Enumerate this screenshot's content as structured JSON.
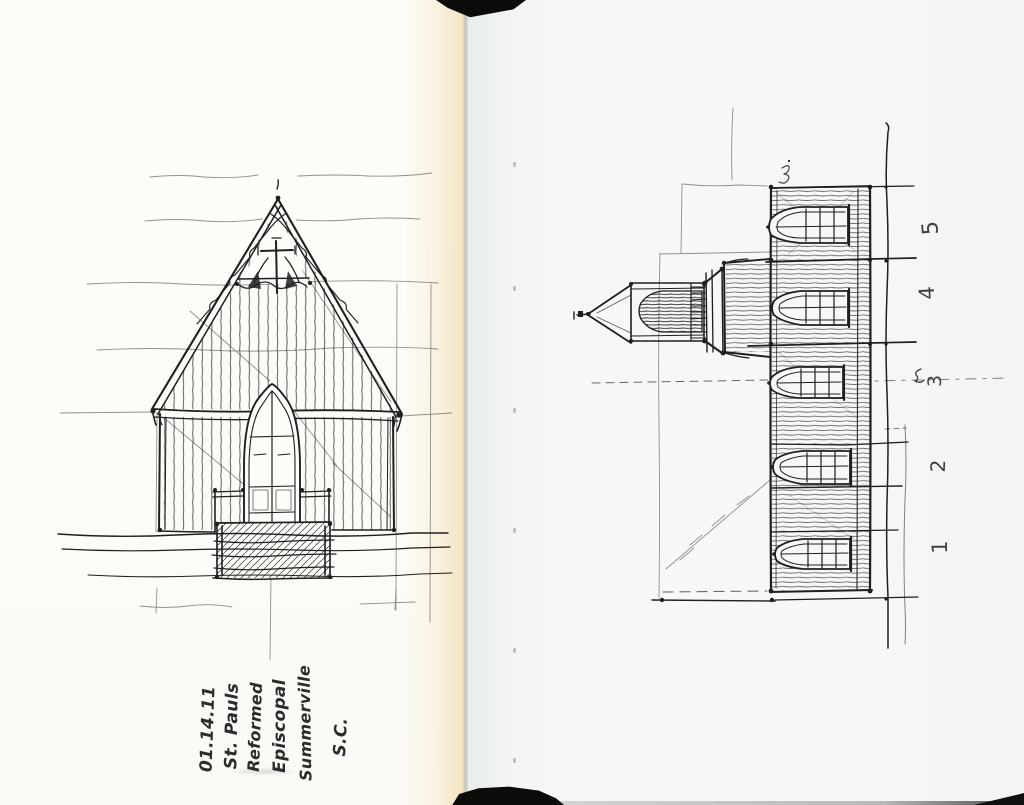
{
  "colors": {
    "ink": "#1f1f1f",
    "paper_left": "#fcfcf9",
    "paper_right": "#f4f7f5",
    "spine_black": "#0b0b09"
  },
  "left_page": {
    "caption_lines": [
      "01.14.11",
      "St. Pauls",
      "Reformed",
      "Episcopal",
      "Summerville",
      "S.C."
    ]
  },
  "right_page": {
    "margin_numbers": [
      "5",
      "4",
      "3",
      "2",
      "1"
    ]
  }
}
